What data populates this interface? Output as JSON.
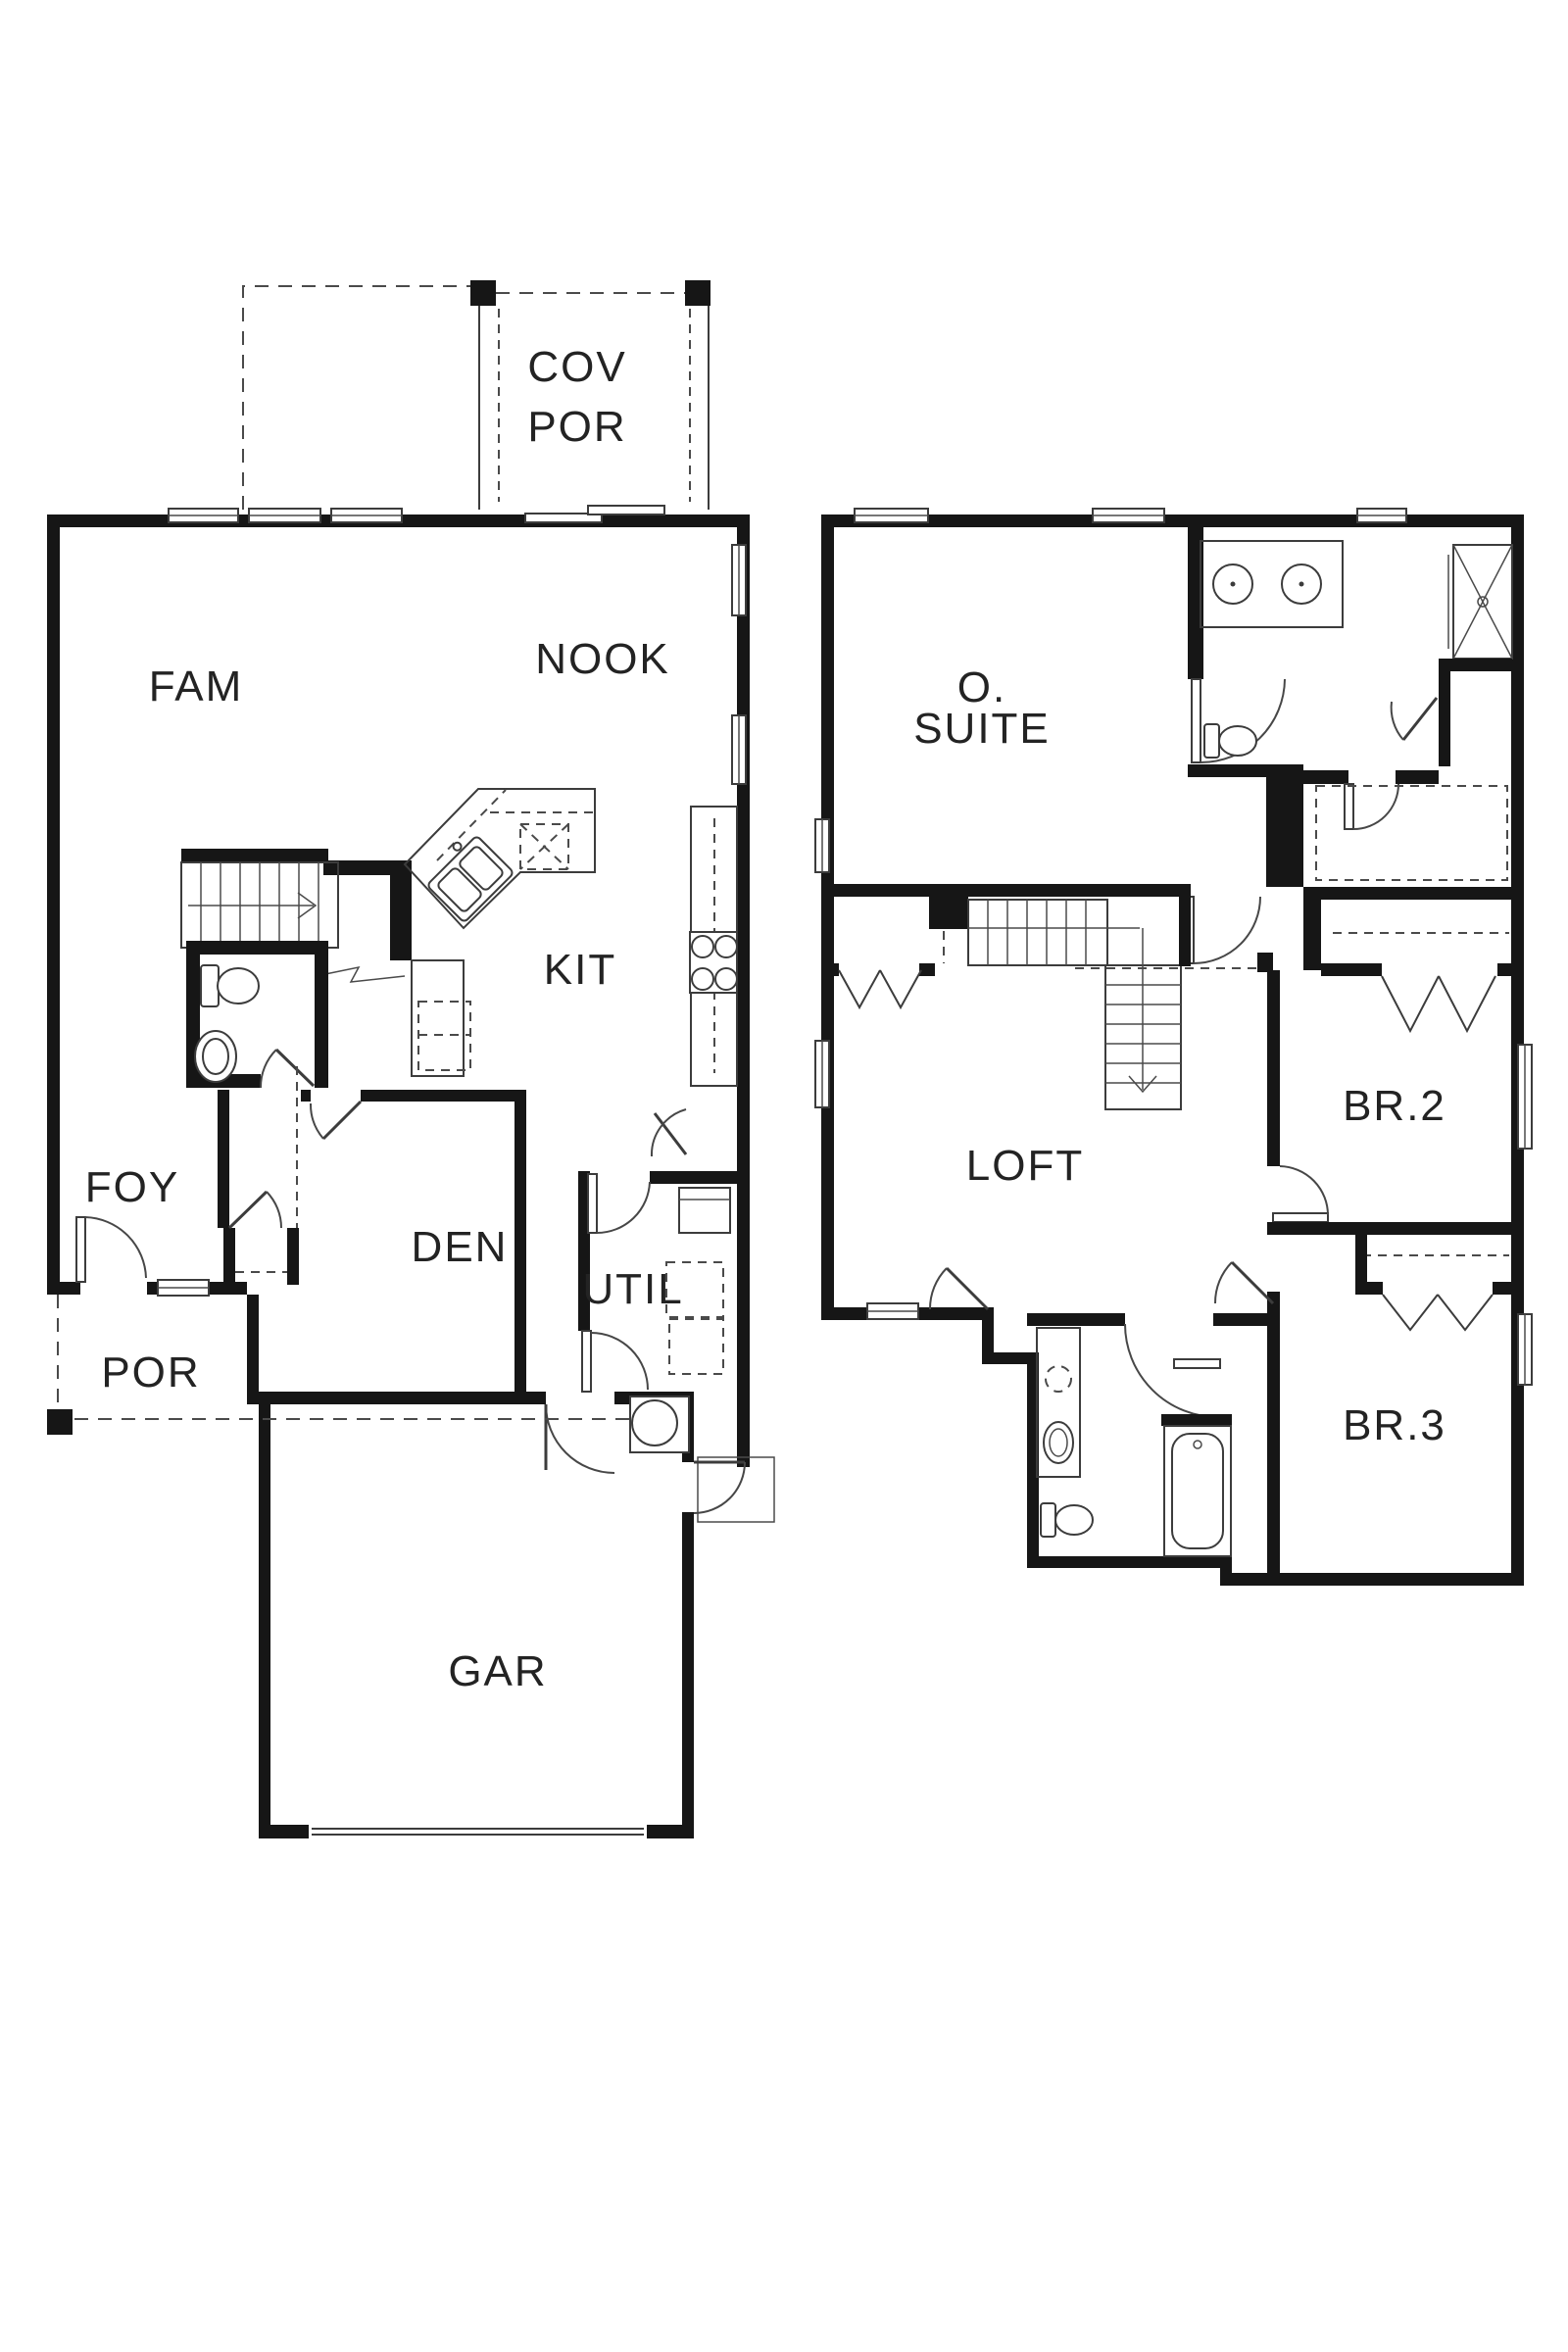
{
  "document": {
    "kind": "architectural floor plan, two levels, black line work on white",
    "wall_color": "#161616",
    "line_color": "#3c3c3c",
    "label_color": "#232323",
    "background": "#ffffff"
  },
  "first_floor": {
    "rooms": {
      "cov_por_line1": "COV",
      "cov_por_line2": "POR",
      "fam": "FAM",
      "nook": "NOOK",
      "kit": "KIT",
      "foy": "FOY",
      "den": "DEN",
      "util": "UTIL",
      "por": "POR",
      "gar": "GAR"
    }
  },
  "second_floor": {
    "rooms": {
      "o_suite_line1": "O.",
      "o_suite_line2": "SUITE",
      "loft": "LOFT",
      "br2": "BR.2",
      "br3": "BR.3"
    }
  }
}
